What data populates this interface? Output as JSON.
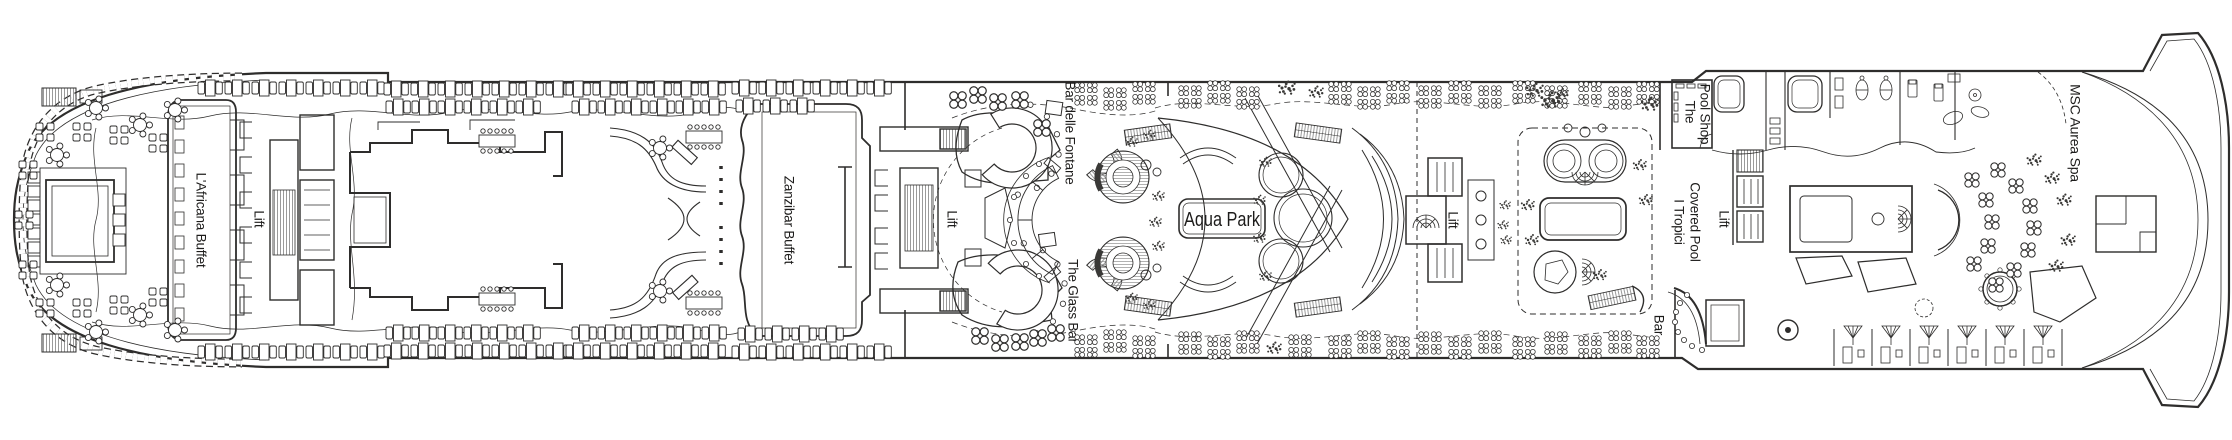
{
  "meta": {
    "title": "Cruise ship deck plan",
    "type": "deck-plan"
  },
  "colors": {
    "ink": "#2e2d2c",
    "paper": "#ffffff",
    "hatch": "#8a8a8a"
  },
  "venues": {
    "africana_buffet": {
      "label": "L'Africana Buffet"
    },
    "lift_1": {
      "label": "Lift"
    },
    "zanzibar_buffet": {
      "label": "Zanzibar Buffet"
    },
    "lift_2": {
      "label": "Lift"
    },
    "bar_delle_fontane": {
      "label": "Bar delle Fontane"
    },
    "the_glass_bar": {
      "label": "The Glass Bar"
    },
    "aqua_park": {
      "label": "Aqua Park"
    },
    "lift_3": {
      "label": "Lift"
    },
    "pool_shop": {
      "label": "The Pool Shop",
      "line1": "The",
      "line2": "Pool Shop"
    },
    "tropici_covered_pool": {
      "label": "I Tropici Covered Pool",
      "line1": "I Tropici",
      "line2": "Covered Pool"
    },
    "lift_4": {
      "label": "Lift"
    },
    "bar": {
      "label": "Bar"
    },
    "msc_aurea_spa": {
      "label": "MSC Aurea Spa"
    }
  }
}
